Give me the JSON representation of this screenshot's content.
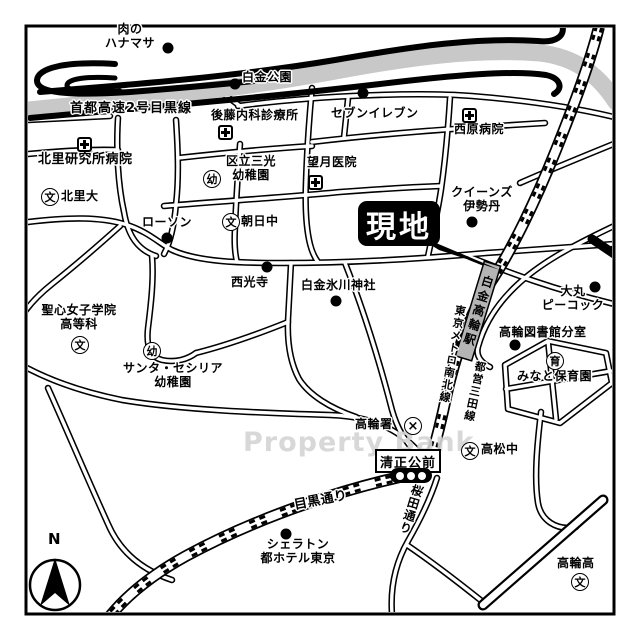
{
  "map": {
    "title_callout": "現地",
    "watermark": "Property Bank",
    "compass": {
      "north_label": "N"
    },
    "colors": {
      "background": "#ffffff",
      "road_casing": "#000000",
      "highway_band": "#c8c8c8",
      "station_fill": "#b5b5b5",
      "watermark_text": "#d4d4d4",
      "callout_bg": "#000000",
      "callout_text": "#ffffff"
    },
    "roads": {
      "expressway": "首都高速2号目黒線",
      "meguro_dori": "目黒通り",
      "sakurada_dori": "桜田通り"
    },
    "transit": {
      "station": "白金高輪駅",
      "namboku_line": "東京メトロ南北線",
      "mita_line": "都営三田線"
    },
    "intersection": {
      "seishoko_mae": "清正公前"
    },
    "pois": {
      "hanamasa": "肉の\nハナマサ",
      "shirokane_park": "白金公園",
      "goto_clinic": "後藤内科診療所",
      "seven_eleven": "セブンイレブン",
      "nishihara_hospital": "西原病院",
      "kitasato_hospital": "北里研究所病院",
      "sanko_kindergarten": "区立三光\n幼稚園",
      "mochizuki_clinic": "望月医院",
      "queens_isetan": "クイーンズ\n伊勢丹",
      "kitasato_univ": "北里大",
      "lawson": "ローソン",
      "asahi_jhs": "朝日中",
      "saikoji": "西光寺",
      "hikawa_shrine": "白金氷川神社",
      "daimaru_peacock": "大丸\nピーコック",
      "takanawa_library": "高輪図書館分室",
      "minato_nursery": "みなと保育園",
      "seishin_school": "聖心女子学院\n高等科",
      "santa_cecilia": "サンタ・セシリア\n幼稚園",
      "takanawa_police": "高輪署",
      "takamatsu_jhs": "高松中",
      "sheraton": "シェラトン\n都ホテル東京",
      "takanawa_hs": "高輪高"
    },
    "symbols": {
      "school": "文",
      "kindergarten": "幼",
      "nursery": "育",
      "police_x": "×"
    }
  }
}
